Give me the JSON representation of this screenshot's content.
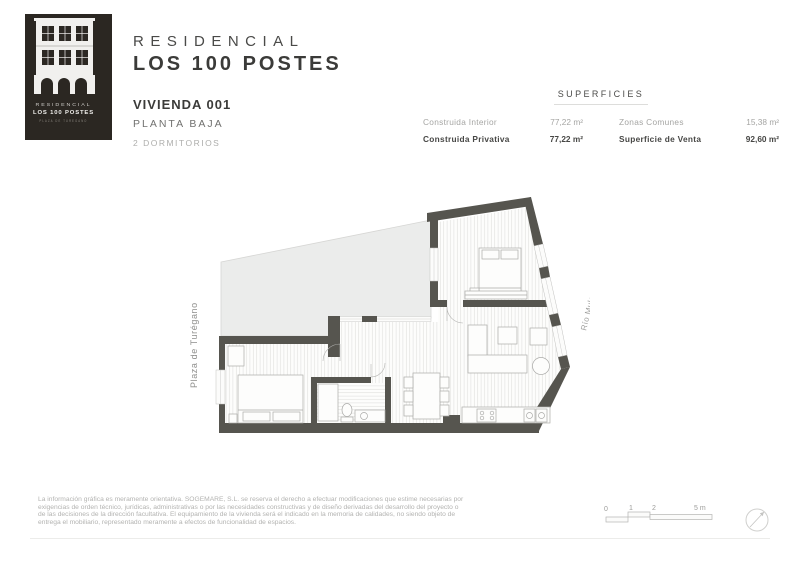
{
  "logo": {
    "line1": "RESIDENCIAL",
    "line2": "LOS 100 POSTES",
    "line3": "PLAZA DE TUREGANO"
  },
  "header": {
    "title_line1": "RESIDENCIAL",
    "title_line2": "LOS 100 POSTES"
  },
  "unit": {
    "name": "VIVIENDA 001",
    "floor": "PLANTA BAJA",
    "rooms": "2 DORMITORIOS"
  },
  "superficies": {
    "title": "SUPERFICIES",
    "rows": [
      {
        "label": "Construida Interior",
        "value": "77,22 m²"
      },
      {
        "label": "Construida Privativa",
        "value": "77,22 m²"
      },
      {
        "label": "Zonas Comunes",
        "value": "15,38 m²"
      },
      {
        "label": "Superficie de Venta",
        "value": "92,60 m²"
      }
    ]
  },
  "plan": {
    "street_left": "Plaza de Turégano",
    "street_right": "Río Mulas"
  },
  "scalebar": {
    "labels": [
      "0",
      "1",
      "2",
      "5 m"
    ]
  },
  "disclaimer": {
    "line1": "La información gráfica es meramente orientativa. SOGEMARE, S.L. se reserva el derecho a efectuar modificaciones que estime necesarias por",
    "line2": "exigencias de orden técnico, jurídicas, administrativas o por las necesidades constructivas y de diseño derivadas del desarrollo del proyecto o",
    "line3": "de las decisiones de la dirección facultativa. El equipamiento de la vivienda será el indicado en la memoria de calidades, no siendo objeto de",
    "line4": "entrega el mobiliario, representado meramente a efectos de funcionalidad de espacios."
  },
  "colors": {
    "wall": "#56554f",
    "patio": "#ebeceb",
    "logo_bg": "#2b2722",
    "accent_dark": "#3b3b39",
    "muted": "#a5a5a3"
  }
}
